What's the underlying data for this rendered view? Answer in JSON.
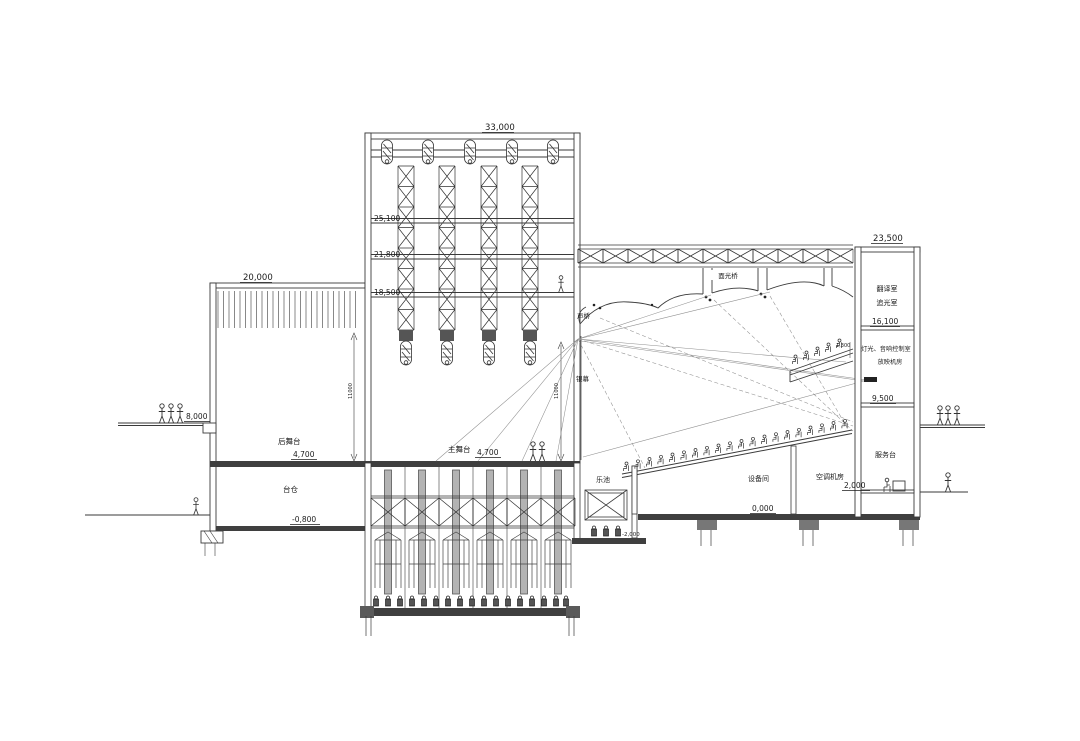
{
  "drawing": {
    "kind": "theatre-longitudinal-section",
    "ink_color": "#3a3a3a",
    "paper_color": "#ffffff",
    "slab_color": "#3f3f3f"
  },
  "labels": {
    "dim_top_tower": "33,000",
    "dim_top_rear": "20,000",
    "dim_top_right": "23,500",
    "lvl_25100": "25,100",
    "lvl_21800": "21,800",
    "lvl_18500": "18,500",
    "lvl_16100": "16,100",
    "lvl_9500": "9,500",
    "lvl_8000": "8,000",
    "lvl_4700_rear": "4,700",
    "lvl_4700_main": "4,700",
    "lvl_2000": "2,000",
    "lvl_0": "0,000",
    "lvl_m0800": "-0,800",
    "lvl_m2000": "-2,000",
    "dim_11000_a": "11000",
    "dim_11000_b": "11000",
    "dim_1300": "1,300",
    "rooms": {
      "rear_stage": "后舞台",
      "trap": "台仓",
      "main_stage": "主舞台",
      "pit": "乐池",
      "equipment": "设备间",
      "hvac": "空调机房",
      "service": "服务台",
      "translation": "翻译室",
      "followspot": "追光室",
      "control": "灯光、音响控制室",
      "projection": "放映机房"
    },
    "bridges": {
      "front_light": "面光桥",
      "sound": "声桥"
    },
    "screen": "银幕"
  }
}
